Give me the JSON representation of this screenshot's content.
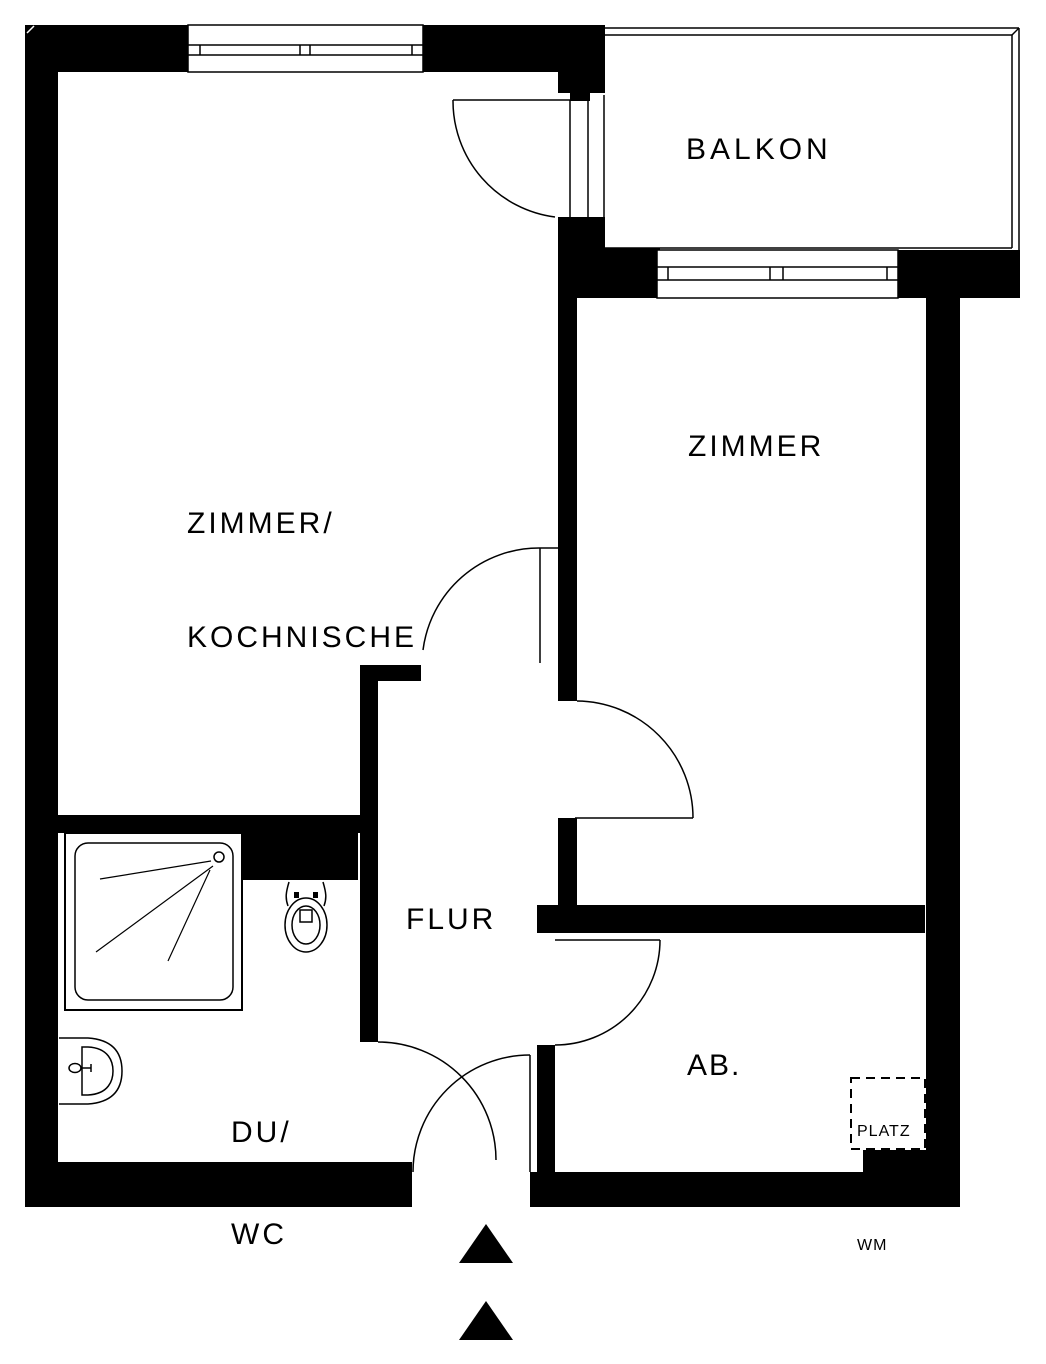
{
  "colors": {
    "wall": "#000000",
    "background": "#ffffff",
    "line": "#000000"
  },
  "rooms": {
    "balkon": {
      "label": "BALKON"
    },
    "zimmer_kochnische": {
      "label_line1": "ZIMMER/",
      "label_line2": "KOCHNISCHE"
    },
    "zimmer": {
      "label": "ZIMMER"
    },
    "flur": {
      "label": "FLUR"
    },
    "du_wc": {
      "label_line1": "DU/",
      "label_line2": "WC"
    },
    "abstellraum": {
      "label": "AB."
    }
  },
  "annotations": {
    "washing_machine_space": {
      "line1": "PLATZ",
      "line2": "FÜR",
      "line3": "WM"
    }
  }
}
